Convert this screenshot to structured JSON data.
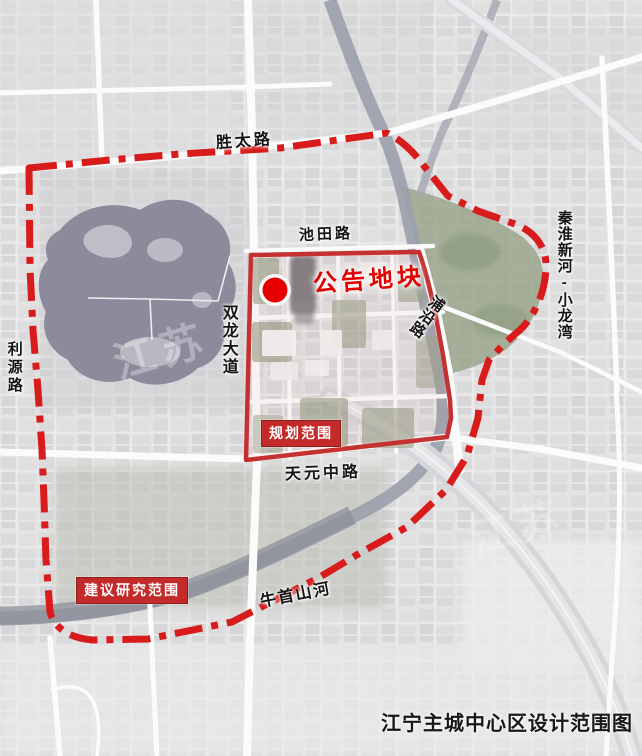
{
  "map": {
    "title": "江宁主城中心区设计范围图",
    "watermark": "江苏",
    "marker": {
      "label": "公告地块",
      "dot_color": "#e60000"
    },
    "boundaries": {
      "planning_scope_label": "规划范围",
      "study_scope_label": "建议研究范围",
      "dash_line_color": "#d81c1c",
      "solid_line_color": "#c53030"
    },
    "roads": {
      "shengtai": "胜太路",
      "chitian": "池田路",
      "puyan": "浦沿路",
      "shuanglong": "双龙大道",
      "liyuan": "利源路",
      "tianyuan": "天元中路"
    },
    "rivers": {
      "qinhuai": "秦淮新河-小龙湾",
      "niushou": "牛首山河"
    }
  }
}
